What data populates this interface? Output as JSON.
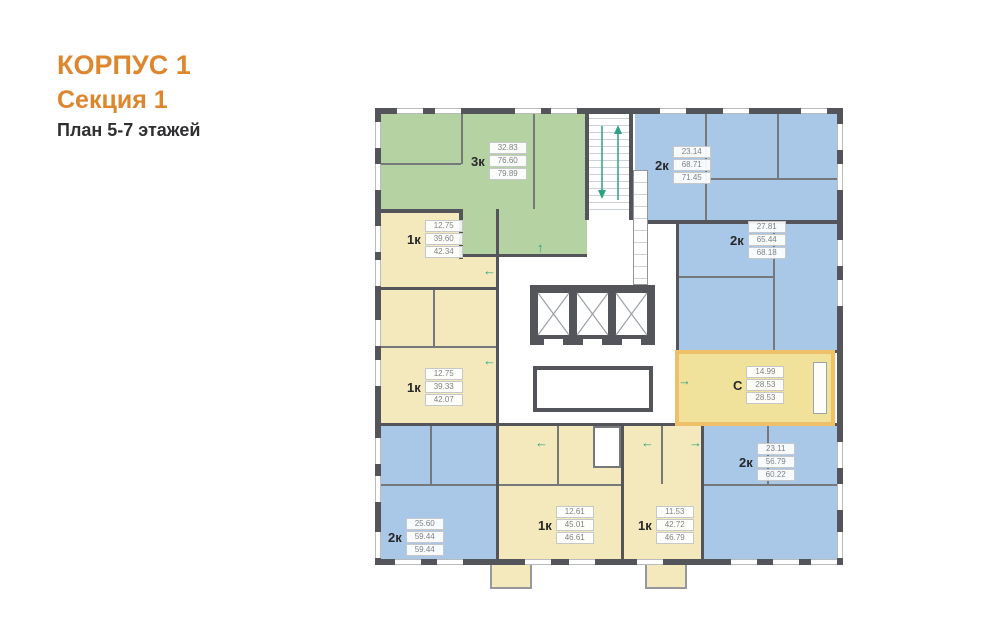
{
  "header": {
    "building": "КОРПУС 1",
    "section": "Секция 1",
    "floors": "План 5-7 этажей"
  },
  "apartments": [
    {
      "name": "3k-top-left",
      "type": "3к",
      "areas": [
        "32.83",
        "76.60",
        "79.89"
      ],
      "color_key": "green"
    },
    {
      "name": "2k-top-right",
      "type": "2к",
      "areas": [
        "23.14",
        "68.71",
        "71.45"
      ],
      "color_key": "blue"
    },
    {
      "name": "1k-left-upper",
      "type": "1к",
      "areas": [
        "12.75",
        "39.60",
        "42.34"
      ],
      "color_key": "yellow"
    },
    {
      "name": "2k-right-middle",
      "type": "2к",
      "areas": [
        "27.81",
        "65.44",
        "68.18"
      ],
      "color_key": "blue"
    },
    {
      "name": "1k-left-lower",
      "type": "1к",
      "areas": [
        "12.75",
        "39.33",
        "42.07"
      ],
      "color_key": "yellow"
    },
    {
      "name": "studio",
      "type": "С",
      "areas": [
        "14.99",
        "28.53",
        "28.53"
      ],
      "color_key": "yellow",
      "highlighted": true
    },
    {
      "name": "2k-right-bottom",
      "type": "2к",
      "areas": [
        "23.11",
        "56.79",
        "60.22"
      ],
      "color_key": "blue"
    },
    {
      "name": "2k-left-bottom",
      "type": "2к",
      "areas": [
        "25.60",
        "59.44",
        "59.44"
      ],
      "color_key": "blue"
    },
    {
      "name": "1k-bottom-middle",
      "type": "1к",
      "areas": [
        "12.61",
        "45.01",
        "46.61"
      ],
      "color_key": "yellow"
    },
    {
      "name": "1k-bottom-right",
      "type": "1к",
      "areas": [
        "11.53",
        "42.72",
        "46.79"
      ],
      "color_key": "yellow"
    }
  ],
  "arrows": [
    {
      "dir": "left",
      "glyph": "←"
    },
    {
      "dir": "left",
      "glyph": "←"
    },
    {
      "dir": "up",
      "glyph": "↑"
    },
    {
      "dir": "right",
      "glyph": "→"
    },
    {
      "dir": "left",
      "glyph": "←"
    },
    {
      "dir": "left",
      "glyph": "←"
    },
    {
      "dir": "right",
      "glyph": "→"
    },
    {
      "dir": "up",
      "glyph": "↑"
    }
  ],
  "colors": {
    "accent": "#DE862D",
    "wall": "#54555A",
    "wall_light": "#77787C",
    "green": "#B5D2A2",
    "blue": "#A9C7E6",
    "yellow": "#F3E9BC",
    "studio_fill": "#F1E29B",
    "highlight": "#EFC06A",
    "arrow": "#2EA183",
    "window_line": "#B9BCBF"
  }
}
